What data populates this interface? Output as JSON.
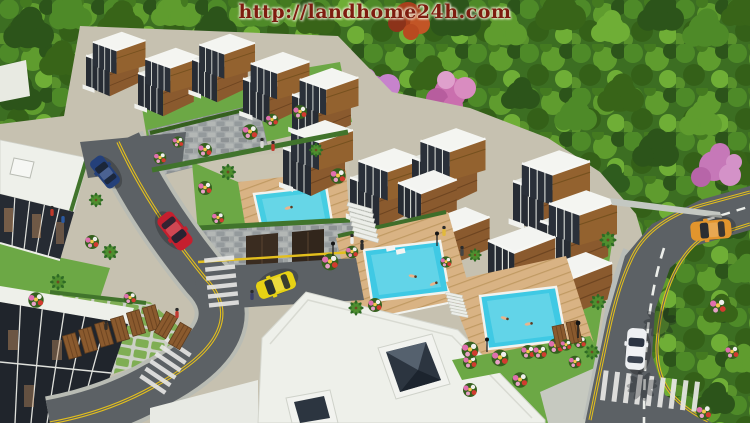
{
  "watermark": {
    "url": "http://landhome24h.com",
    "text_color": "#7e1c10"
  },
  "scene": {
    "description": "Aerial 3D architectural rendering of a terraced hillside villa estate with rooftop swimming pools, tree-lined roads and dense forest",
    "palette": {
      "forest_base": "#3c6e22",
      "blossom_pink": "#c678c0",
      "autumn_red": "#b0451f",
      "ground": "#c6c1b0",
      "lawn_green": "#6ca845",
      "roof_white": "#eef0ea",
      "villa_glass": "#23282f",
      "villa_wood": "#8a5a2e",
      "stone_wall": "#a3a8a8",
      "deck_wood": "#d9b384",
      "pool_water": "#3fc9e4",
      "road_asphalt": "#5c6165",
      "lane_yellow": "#e3bf1d",
      "marking_white": "#e8e8e6"
    },
    "pools": [
      {
        "name": "rooftop-terrace-pool",
        "color": "#45cde2"
      },
      {
        "name": "middle-deck-pool",
        "color": "#3fc9e4"
      },
      {
        "name": "lower-deck-pool",
        "color": "#3fc9e4"
      }
    ],
    "cars": [
      {
        "name": "sedan-dark-blue",
        "color": "#24407a"
      },
      {
        "name": "sedan-red",
        "color": "#c51f2e"
      },
      {
        "name": "sedan-yellow",
        "color": "#e7d214"
      },
      {
        "name": "sedan-orange",
        "color": "#e2952d"
      },
      {
        "name": "sedan-white",
        "color": "#eef0f2"
      }
    ]
  }
}
